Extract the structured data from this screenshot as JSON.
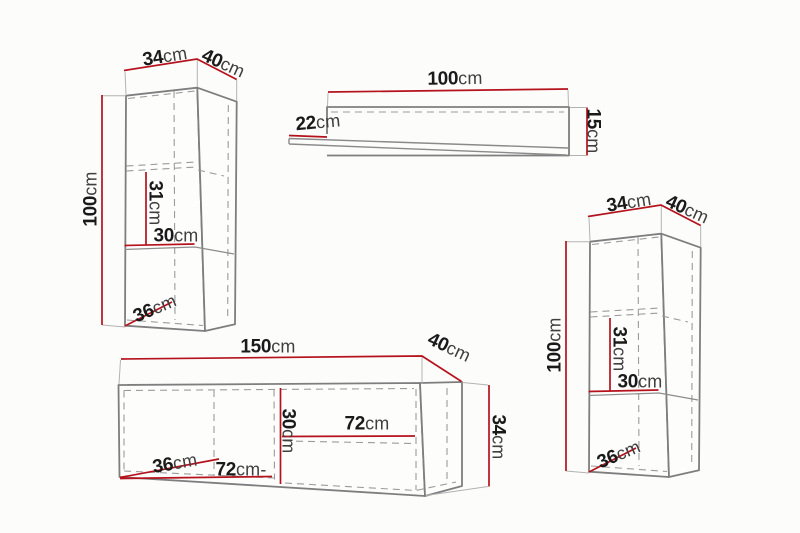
{
  "colors": {
    "background": "#fcfcfa",
    "dimension_line": "#b5121d",
    "outline": "#7e7e7e",
    "hidden_line": "#9b9b9b",
    "number_text": "#1a1a1a",
    "unit_text": "#3f3f3f"
  },
  "pieces": [
    {
      "id": "wall-cabinet-left",
      "labels": {
        "width": {
          "v": "34",
          "u": "cm"
        },
        "depth": {
          "v": "40",
          "u": "cm"
        },
        "height": {
          "v": "100",
          "u": "cm"
        },
        "inner_height": {
          "v": "31",
          "u": "cm"
        },
        "inner_width": {
          "v": "30",
          "u": "cm"
        },
        "bottom_depth": {
          "v": "36",
          "u": "cm"
        }
      }
    },
    {
      "id": "wall-shelf",
      "labels": {
        "width": {
          "v": "100",
          "u": "cm"
        },
        "depth": {
          "v": "22",
          "u": "cm"
        },
        "height": {
          "v": "15",
          "u": "cm"
        }
      }
    },
    {
      "id": "wall-cabinet-right",
      "labels": {
        "width": {
          "v": "34",
          "u": "cm"
        },
        "depth": {
          "v": "40",
          "u": "cm"
        },
        "height": {
          "v": "100",
          "u": "cm"
        },
        "inner_height": {
          "v": "31",
          "u": "cm"
        },
        "inner_width": {
          "v": "30",
          "u": "cm"
        },
        "bottom_depth": {
          "v": "36",
          "u": "cm"
        }
      }
    },
    {
      "id": "tv-stand",
      "labels": {
        "width": {
          "v": "150",
          "u": "cm"
        },
        "depth": {
          "v": "40",
          "u": "cm"
        },
        "height": {
          "v": "34",
          "u": "cm"
        },
        "inner_height": {
          "v": "30",
          "u": "cm"
        },
        "shelf_width": {
          "v": "72",
          "u": "cm"
        },
        "bottom_depth": {
          "v": "36",
          "u": "cm"
        },
        "bottom_width": {
          "v": "72",
          "u": "cm-"
        }
      }
    }
  ]
}
